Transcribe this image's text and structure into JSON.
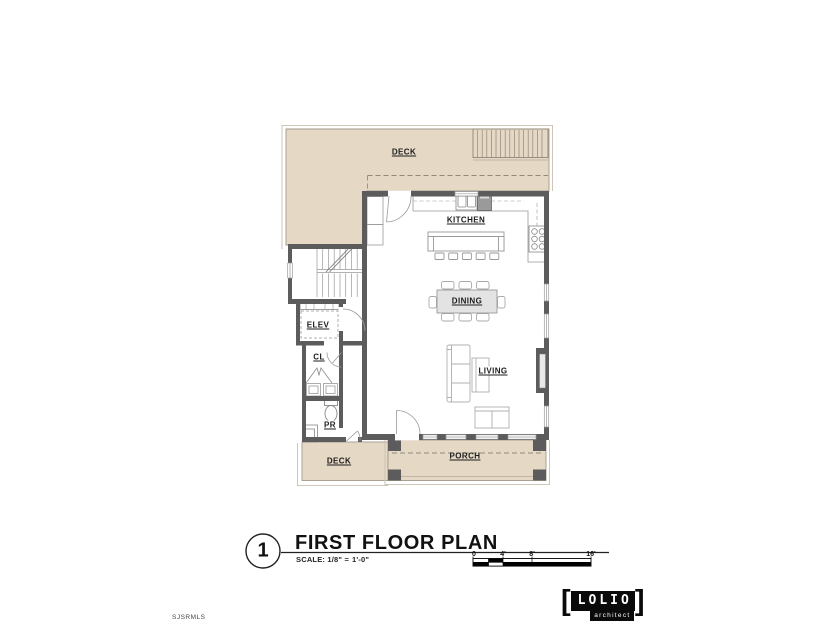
{
  "floor_plan": {
    "labels": {
      "deck_top": "DECK",
      "kitchen": "KITCHEN",
      "dining": "DINING",
      "living": "LIVING",
      "elevator": "ELEV",
      "closet": "CL",
      "powder_room": "PR",
      "deck_bottom": "DECK",
      "porch": "PORCH"
    }
  },
  "title_block": {
    "drawing_number": "1",
    "title": "FIRST FLOOR PLAN",
    "scale_prefix": "SCALE: 1/8\" =",
    "scale_value": "1'-0\"",
    "scale_bar": {
      "ticks": [
        "0",
        "4'",
        "8'",
        "16'"
      ]
    }
  },
  "watermark": "SJSRMLS",
  "logo": {
    "bracket_left": "[",
    "name": "LOLIO",
    "bracket_right": "]",
    "subtitle": "architect"
  },
  "colors": {
    "deck_fill": "#e5d8c5",
    "wall": "#5c5c5c",
    "light_line": "#a39a8a",
    "table_fill": "#e3e3e3"
  }
}
